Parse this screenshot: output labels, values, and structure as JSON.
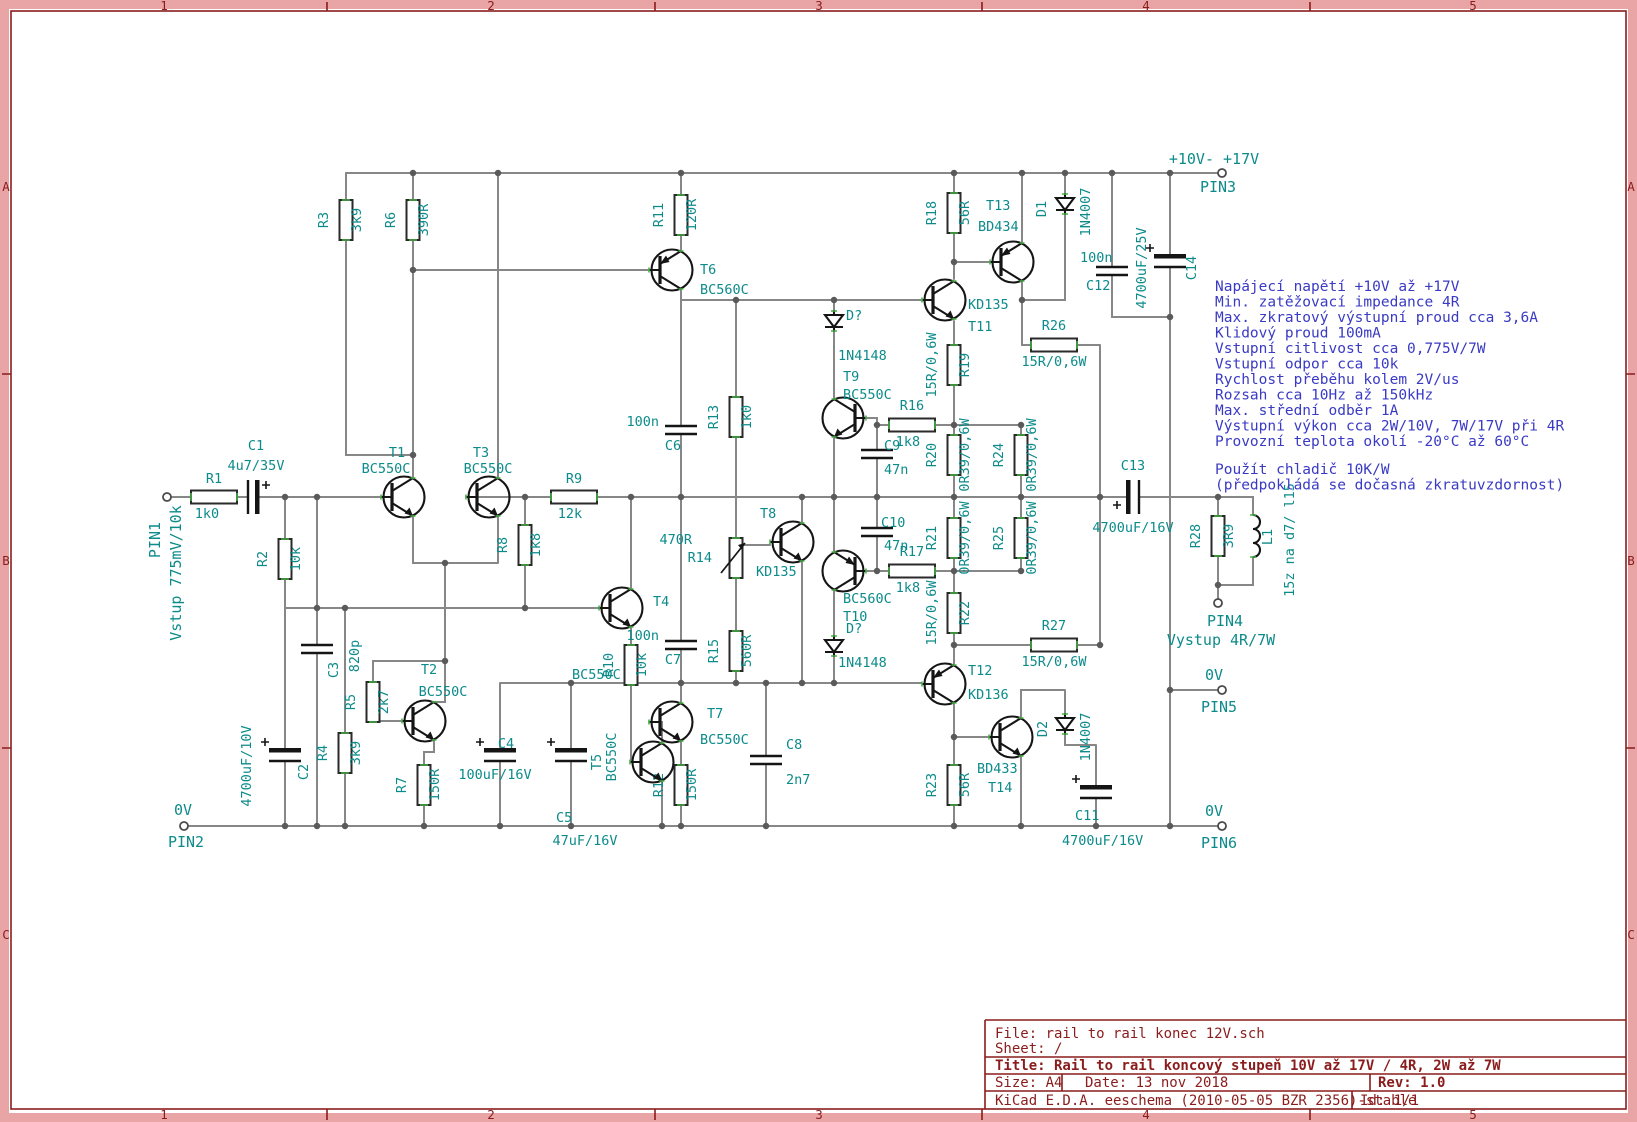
{
  "colors": {
    "wire": "#878787",
    "component_outline": "#151515",
    "field_label": "#0d8b8b",
    "note_text": "#3a3ac4",
    "frame_red": "#8a1c1c",
    "frame_band_pink": "#e9a5a5",
    "pin_tick_green": "#46b24e",
    "background": "#ffffff"
  },
  "frame": {
    "columns": [
      "1",
      "2",
      "3",
      "4",
      "5"
    ],
    "rows": [
      "A",
      "B",
      "C"
    ]
  },
  "title_block": {
    "file": "File: rail to rail konec 12V.sch",
    "sheet": "Sheet: /",
    "title": "Title: Rail to rail koncový stupeň 10V až 17V / 4R, 2W až 7W",
    "size": "Size: A4",
    "date": "Date: 13 nov 2018",
    "rev": "Rev: 1.0",
    "tool": "KiCad E.D.A.  eeschema (2010-05-05 BZR 2356)-stable",
    "id": "Id: 1/1"
  },
  "notes": {
    "lines": [
      "Napájecí napětí +10V až +17V",
      "Min. zatěžovací impedance 4R",
      "Max. zkratový výstupní proud cca 3,6A",
      "Klidový proud 100mA",
      "Vstupní citlivost cca 0,775V/7W",
      "Vstupní odpor cca 10k",
      "Rychlost přeběhu kolem 2V/us",
      "Rozsah cca 10Hz až 150kHz",
      "Max. střední odběr 1A",
      "Výstupní výkon cca 2W/10V, 7W/17V při 4R",
      "Provozní teplota okolí -20°C až 60°C"
    ],
    "footer": [
      "Použít chladič 10K/W",
      "(předpokládá se dočasná zkratuvzdornost)"
    ]
  },
  "pins": {
    "PIN1": {
      "name": "PIN1",
      "net": "Vstup 775mV/10k"
    },
    "PIN2": {
      "name": "PIN2",
      "net": "0V"
    },
    "PIN3": {
      "name": "PIN3",
      "net": "+10V- +17V"
    },
    "PIN4": {
      "name": "PIN4",
      "net": "Vystup 4R/7W"
    },
    "PIN5": {
      "name": "PIN5",
      "net": "0V"
    },
    "PIN6": {
      "name": "PIN6",
      "net": "0V"
    }
  },
  "components": {
    "R1": {
      "ref": "R1",
      "value": "1k0"
    },
    "R2": {
      "ref": "R2",
      "value": "10k"
    },
    "R3": {
      "ref": "R3",
      "value": "3k9"
    },
    "R4": {
      "ref": "R4",
      "value": "3k9"
    },
    "R5": {
      "ref": "R5",
      "value": "2k7"
    },
    "R6": {
      "ref": "R6",
      "value": "390R"
    },
    "R7": {
      "ref": "R7",
      "value": "150R"
    },
    "R8": {
      "ref": "R8",
      "value": "1k8"
    },
    "R9": {
      "ref": "R9",
      "value": "12k"
    },
    "R10": {
      "ref": "R10",
      "value": "10k"
    },
    "R11": {
      "ref": "R11",
      "value": "120R"
    },
    "R12": {
      "ref": "R12",
      "value": "150R"
    },
    "R13": {
      "ref": "R13",
      "value": "1k0"
    },
    "R14": {
      "ref": "R14",
      "value": "470R"
    },
    "R15": {
      "ref": "R15",
      "value": "560R"
    },
    "R16": {
      "ref": "R16",
      "value": "1k8"
    },
    "R17": {
      "ref": "R17",
      "value": "1k8"
    },
    "R18": {
      "ref": "R18",
      "value": "56R"
    },
    "R19": {
      "ref": "R19",
      "value": "15R/0,6W"
    },
    "R20": {
      "ref": "R20",
      "value": "0R39/0,6W"
    },
    "R21": {
      "ref": "R21",
      "value": "0R39/0,6W"
    },
    "R22": {
      "ref": "R22",
      "value": "15R/0,6W"
    },
    "R23": {
      "ref": "R23",
      "value": "56R"
    },
    "R24": {
      "ref": "R24",
      "value": "0R39/0,6W"
    },
    "R25": {
      "ref": "R25",
      "value": "0R39/0,6W"
    },
    "R26": {
      "ref": "R26",
      "value": "15R/0,6W"
    },
    "R27": {
      "ref": "R27",
      "value": "15R/0,6W"
    },
    "R28": {
      "ref": "R28",
      "value": "3R9"
    },
    "C1": {
      "ref": "C1",
      "value": "4u7/35V"
    },
    "C2": {
      "ref": "C2",
      "value": "4700uF/10V"
    },
    "C3": {
      "ref": "C3",
      "value": "820p"
    },
    "C4": {
      "ref": "C4",
      "value": "100uF/16V"
    },
    "C5": {
      "ref": "C5",
      "value": "47uF/16V"
    },
    "C6": {
      "ref": "C6",
      "value": "100n"
    },
    "C7": {
      "ref": "C7",
      "value": "100n"
    },
    "C8": {
      "ref": "C8",
      "value": "2n7"
    },
    "C9": {
      "ref": "C9",
      "value": "47n"
    },
    "C10": {
      "ref": "C10",
      "value": "47n"
    },
    "C11": {
      "ref": "C11",
      "value": "4700uF/16V"
    },
    "C12": {
      "ref": "C12",
      "value": "100n"
    },
    "C13": {
      "ref": "C13",
      "value": "4700uF/16V"
    },
    "C14": {
      "ref": "C14",
      "value": "4700uF/25V"
    },
    "T1": {
      "ref": "T1",
      "value": "BC550C"
    },
    "T2": {
      "ref": "T2",
      "value": "BC550C"
    },
    "T3": {
      "ref": "T3",
      "value": "BC550C"
    },
    "T4": {
      "ref": "T4",
      "value": "BC550C"
    },
    "T5": {
      "ref": "T5",
      "value": "BC550C"
    },
    "T6": {
      "ref": "T6",
      "value": "BC560C"
    },
    "T7": {
      "ref": "T7",
      "value": "BC550C"
    },
    "T8": {
      "ref": "T8",
      "value": "KD135"
    },
    "T9": {
      "ref": "T9",
      "value": "BC550C"
    },
    "T10": {
      "ref": "T10",
      "value": "BC560C"
    },
    "T11": {
      "ref": "T11",
      "value": "KD135"
    },
    "T12": {
      "ref": "T12",
      "value": "KD136"
    },
    "T13": {
      "ref": "T13",
      "value": "BD434"
    },
    "T14": {
      "ref": "T14",
      "value": "BD433"
    },
    "DQ1": {
      "ref": "D?",
      "value": "1N4148"
    },
    "DQ2": {
      "ref": "D?",
      "value": "1N4148"
    },
    "D1": {
      "ref": "D1",
      "value": "1N4007"
    },
    "D2": {
      "ref": "D2",
      "value": "1N4007"
    },
    "L1": {
      "ref": "L1",
      "value": "15z na d7/ l15"
    }
  }
}
